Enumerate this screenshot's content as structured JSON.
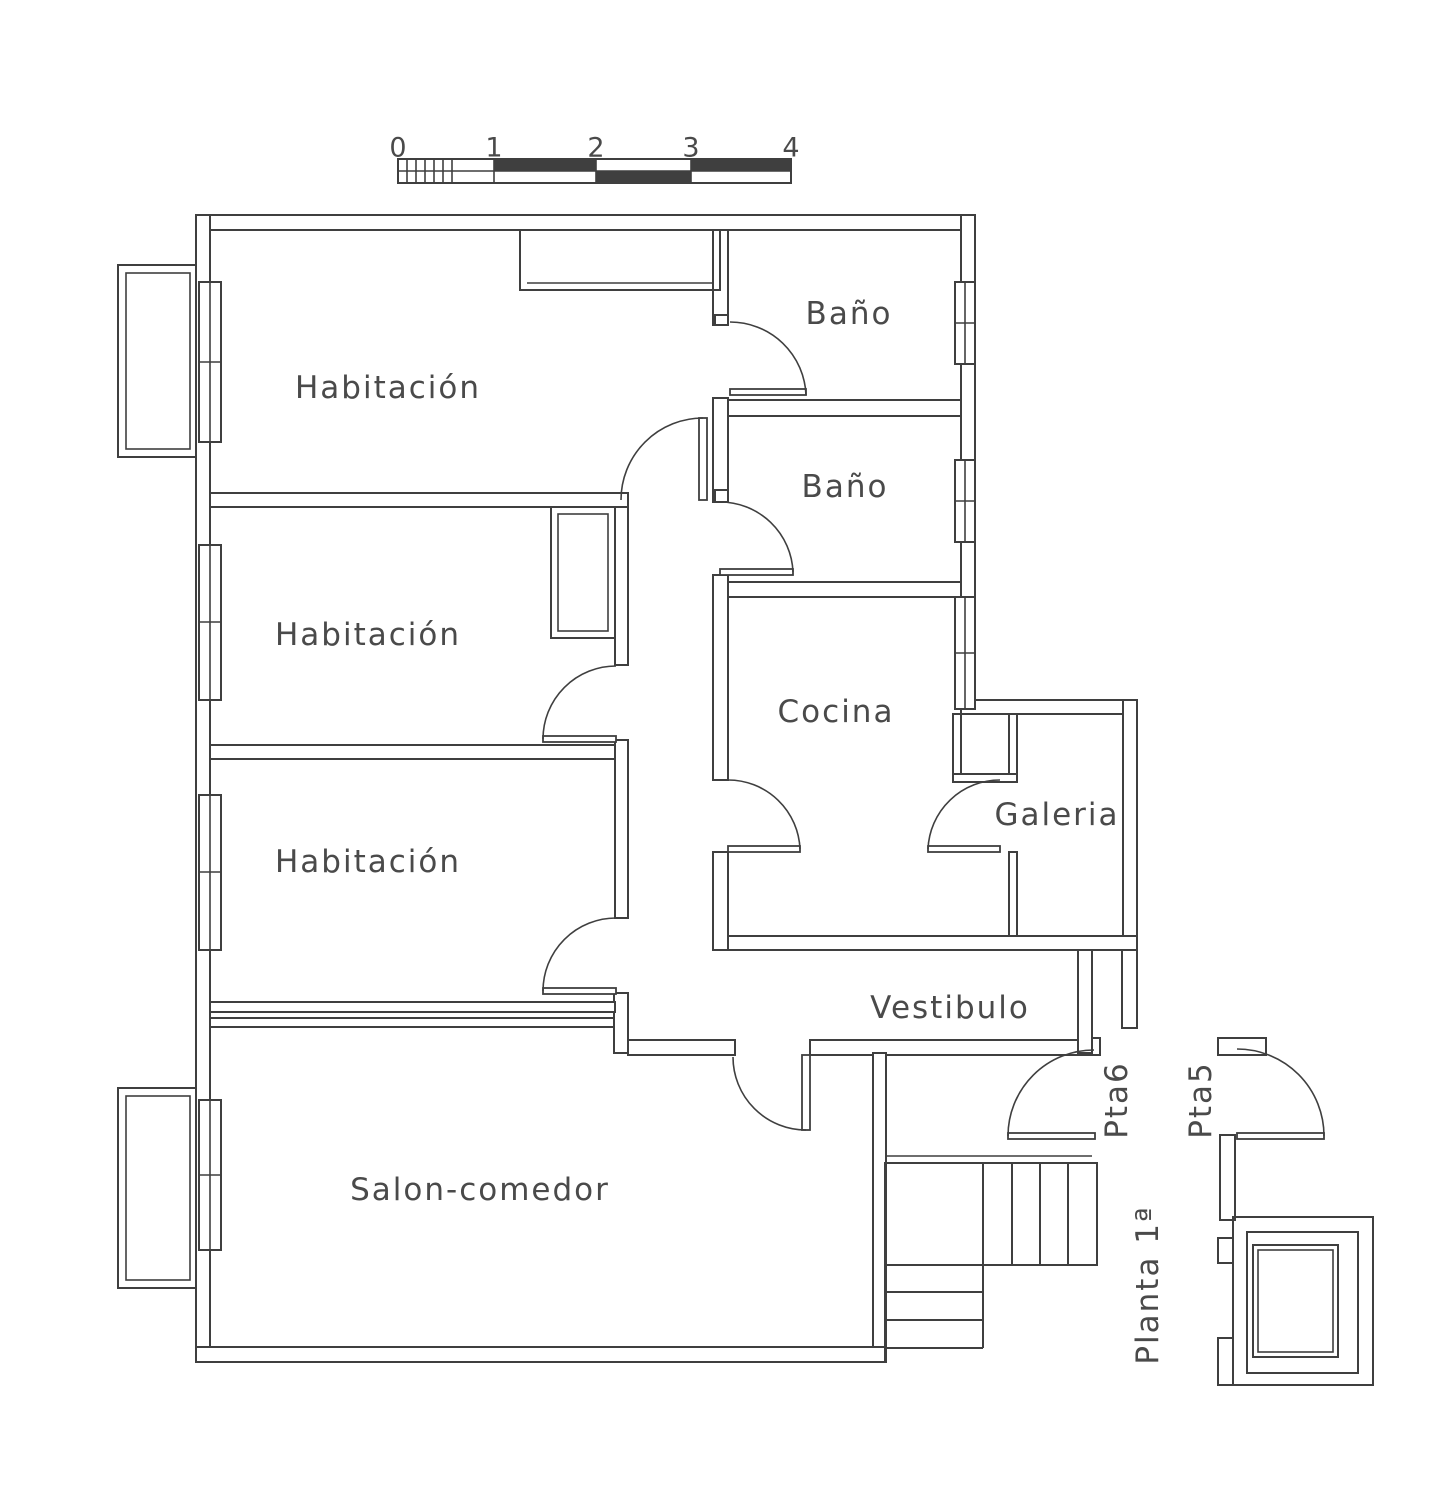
{
  "colors": {
    "line": "#3f3f3f",
    "text": "#4a4a4a",
    "background": "#ffffff"
  },
  "plan_title": {
    "label": "Planta 1ª",
    "x": 1148,
    "y": 1285,
    "rotated": true
  },
  "scale_bar": {
    "numbers": [
      {
        "label": "0",
        "x": 398,
        "y": 148
      },
      {
        "label": "1",
        "x": 494,
        "y": 148
      },
      {
        "label": "2",
        "x": 596,
        "y": 148
      },
      {
        "label": "3",
        "x": 691,
        "y": 148
      },
      {
        "label": "4",
        "x": 791,
        "y": 148
      }
    ]
  },
  "rooms": [
    {
      "id": "habitacion-1",
      "label": "Habitación",
      "x": 388,
      "y": 388
    },
    {
      "id": "habitacion-2",
      "label": "Habitación",
      "x": 368,
      "y": 635
    },
    {
      "id": "habitacion-3",
      "label": "Habitación",
      "x": 368,
      "y": 862
    },
    {
      "id": "bano-1",
      "label": "Baño",
      "x": 849,
      "y": 314
    },
    {
      "id": "bano-2",
      "label": "Baño",
      "x": 845,
      "y": 487
    },
    {
      "id": "cocina",
      "label": "Cocina",
      "x": 836,
      "y": 712
    },
    {
      "id": "galeria",
      "label": "Galeria",
      "x": 1057,
      "y": 815
    },
    {
      "id": "vestibulo",
      "label": "Vestibulo",
      "x": 950,
      "y": 1008
    },
    {
      "id": "salon-comedor",
      "label": "Salon-comedor",
      "x": 480,
      "y": 1190
    }
  ],
  "door_tags": [
    {
      "id": "pta6",
      "label": "Pta6",
      "x": 1117,
      "y": 1100,
      "rotated": true
    },
    {
      "id": "pta5",
      "label": "Pta5",
      "x": 1201,
      "y": 1100,
      "rotated": true
    }
  ]
}
